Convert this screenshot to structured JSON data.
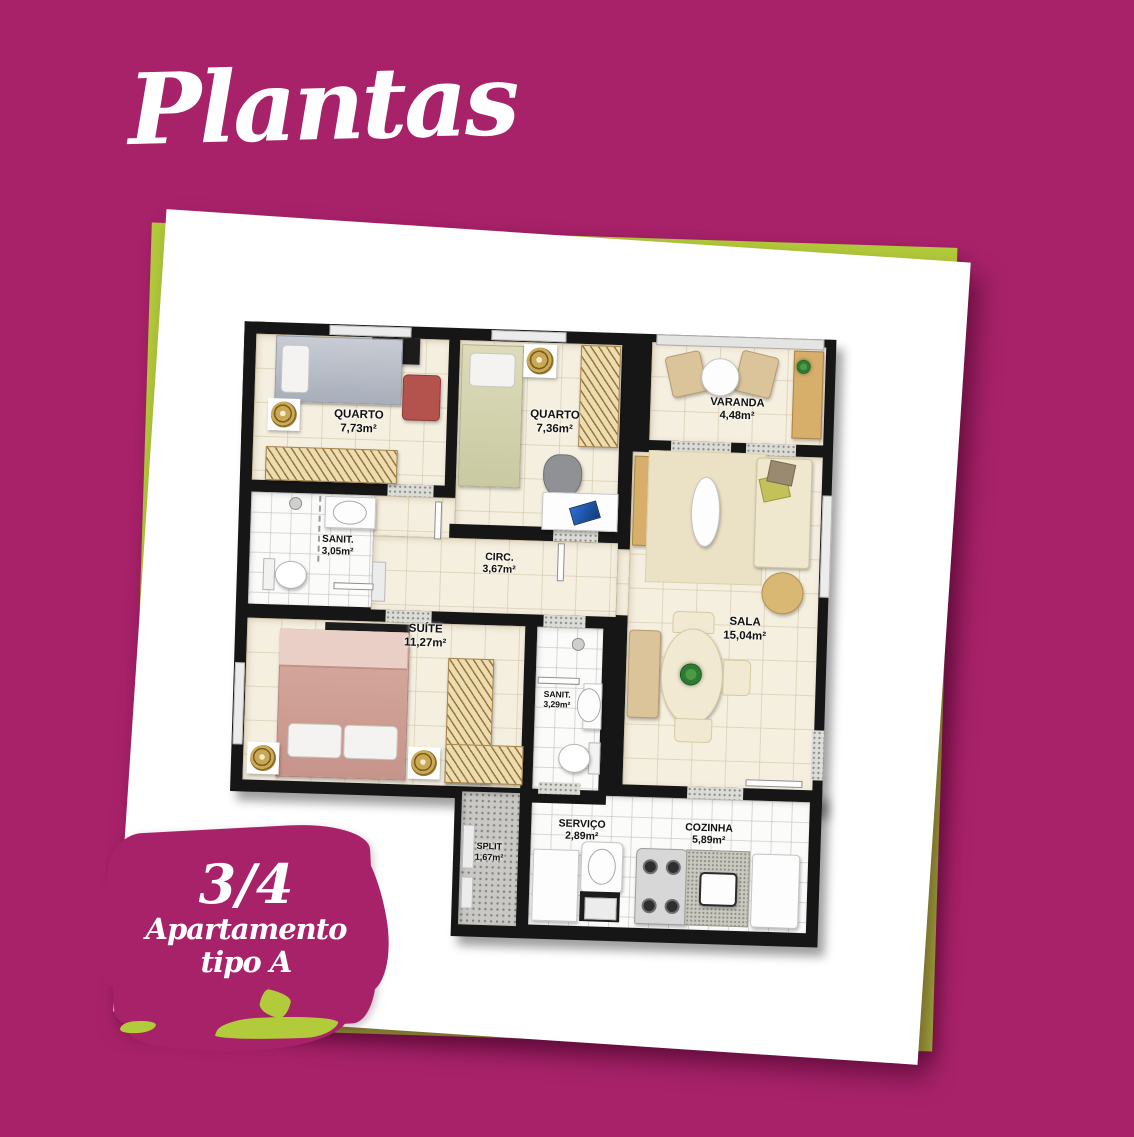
{
  "title": "Plantas",
  "badge": {
    "fraction": "3/4",
    "line1": "Apartamento",
    "line2": "tipo A"
  },
  "colors": {
    "background": "#a8226a",
    "lime": "#b2cb3a",
    "wall": "#161616",
    "floor": "#f5efe0"
  },
  "plan": {
    "rooms": {
      "quarto1": {
        "name": "QUARTO",
        "area": "7,73m²"
      },
      "quarto2": {
        "name": "QUARTO",
        "area": "7,36m²"
      },
      "varanda": {
        "name": "VARANDA",
        "area": "4,48m²"
      },
      "sanit1": {
        "name": "SANIT.",
        "area": "3,05m²"
      },
      "circ": {
        "name": "CIRC.",
        "area": "3,67m²"
      },
      "sala": {
        "name": "SALA",
        "area": "15,04m²"
      },
      "suite": {
        "name": "SUÍTE",
        "area": "11,27m²"
      },
      "sanit2": {
        "name": "SANIT.",
        "area": "3,29m²"
      },
      "split": {
        "name": "SPLIT",
        "area": "1,67m²"
      },
      "servico": {
        "name": "SERVIÇO",
        "area": "2,89m²"
      },
      "cozinha": {
        "name": "COZINHA",
        "area": "5,89m²"
      }
    }
  }
}
